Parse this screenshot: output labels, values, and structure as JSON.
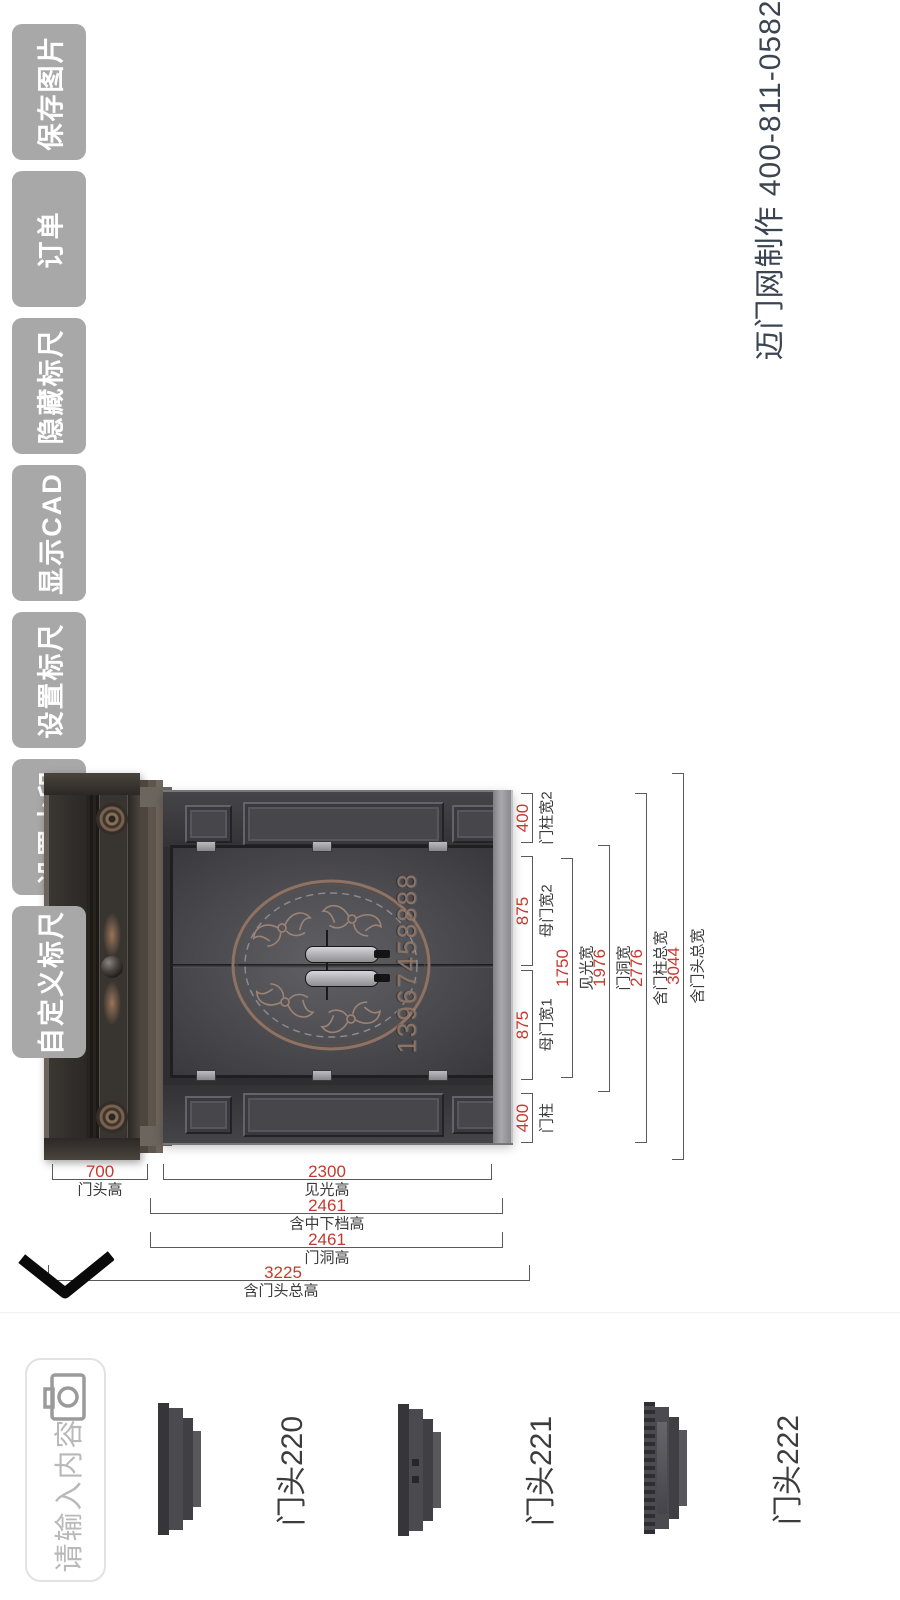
{
  "toolbar": {
    "buttons": [
      {
        "label": "保存图片"
      },
      {
        "label": "订单"
      },
      {
        "label": "隐藏标尺"
      },
      {
        "label": "显示CAD"
      },
      {
        "label": "设置标尺"
      },
      {
        "label": "设置水印"
      },
      {
        "label": "自定义标尺"
      }
    ]
  },
  "watermark": {
    "text": "迈门网制作 400-811-0582"
  },
  "door_preview": {
    "phone_engraving": "13967458888"
  },
  "dimensions": {
    "width": [
      {
        "value": "400",
        "label": "门柱宽2"
      },
      {
        "value": "875",
        "label": "母门宽2"
      },
      {
        "value": "875",
        "label": "母门宽1"
      },
      {
        "value": "400",
        "label": "门柱"
      },
      {
        "value": "1750",
        "label": "见光宽"
      },
      {
        "value": "1976",
        "label": "门洞宽"
      },
      {
        "value": "2776",
        "label": "含门柱总宽"
      },
      {
        "value": "3044",
        "label": "含门头总宽"
      }
    ],
    "height": [
      {
        "value": "700",
        "label": "门头高"
      },
      {
        "value": "2300",
        "label": "见光高"
      },
      {
        "value": "2461",
        "label": "含中下档高"
      },
      {
        "value": "2461",
        "label": "门洞高"
      },
      {
        "value": "3225",
        "label": "含门头总高"
      }
    ]
  },
  "bottom_bar": {
    "input_placeholder": "请输入内容",
    "items": [
      {
        "label": "门头220"
      },
      {
        "label": "门头221"
      },
      {
        "label": "门头222"
      }
    ]
  },
  "colors": {
    "dim_value_red": "#c43a2e",
    "button_gray": "#a8a8a8",
    "watermark_dark": "#3b4552"
  }
}
